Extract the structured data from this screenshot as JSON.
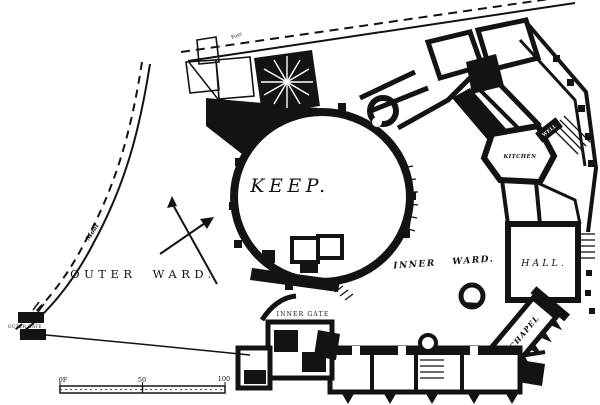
{
  "figure": {
    "type": "castle-ground-plan",
    "ink_color": "#131313",
    "paper_color": "#ffffff"
  },
  "labels": {
    "keep": "KEEP.",
    "outer_ward": "OUTER WARD.",
    "inner_ward": "INNER WARD.",
    "hall": "HALL.",
    "kitchen": "KITCHEN",
    "chapel": "CHAPEL",
    "inner_gate": "INNER GATE",
    "outer_gate": "OUTER GATE",
    "moat": "Moat",
    "foss": "Foss",
    "well": "WELL"
  },
  "scale_bar": {
    "zero_label": "0F",
    "mid_label": "50",
    "end_label": "100"
  }
}
